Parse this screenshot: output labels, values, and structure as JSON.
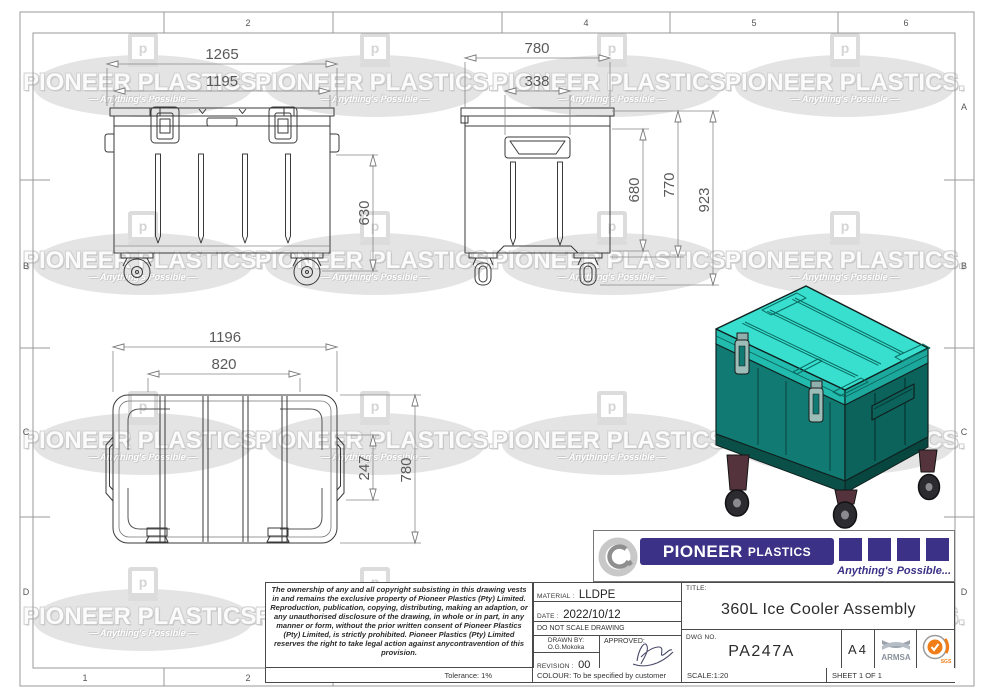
{
  "sheet": {
    "grid": {
      "top": [
        "2",
        "4",
        "5",
        "6"
      ],
      "bottom": [
        "1",
        "2"
      ],
      "left": [
        "B",
        "C",
        "D"
      ],
      "right": [
        "A",
        "B",
        "C",
        "D"
      ]
    }
  },
  "watermark": {
    "brand": "PIONEER PLASTICS.",
    "tagline": "— Anything's Possible —",
    "logo_letter": "p"
  },
  "views": {
    "front": {
      "dims": {
        "overall_width": "1265",
        "lid_width": "1195",
        "body_height": "630"
      }
    },
    "side": {
      "dims": {
        "overall_depth": "780",
        "handle_width": "338",
        "inner_height": "680",
        "body_height": "770",
        "overall_height": "923"
      }
    },
    "top": {
      "dims": {
        "overall_length": "1196",
        "lid_length": "820",
        "handle_span": "247",
        "overall_depth": "780"
      }
    }
  },
  "brand": {
    "name": "PIONEER",
    "name2": "PLASTICS",
    "tagline": "Anything's Possible...",
    "purple": "#3b3187"
  },
  "copyright": {
    "text": "The ownership of any and all copyright subsisting in this drawing vests in and remains the exclusive property of Pioneer Plastics (Pty) Limited. Reproduction, publication, copying, distributing, making an adaption, or any unauthorised disclosure of the drawing, in whole or in part, in any manner or form, without the prior written consent of Pioneer Plastics (Pty) Limited, is strictly prohibited. Pioneer Plastics (Pty) Limited reserves the right to take legal action against anycontravention of this provision.",
    "tolerance": "Tolerance: 1%"
  },
  "title_block": {
    "material_label": "MATERIAL :",
    "material": "LLDPE",
    "date_label": "DATE :",
    "date": "2022/10/12",
    "no_scale": "DO NOT SCALE DRAWING",
    "drawn_by_label": "DRAWN BY:",
    "drawn_by": "O.G.Mokoka",
    "approved_label": "APPROVED:",
    "revision_label": "REVISION :",
    "revision": "00",
    "title_label": "TITLE:",
    "title": "360L Ice Cooler Assembly",
    "dwg_label": "DWG NO.",
    "dwg_no": "PA247A",
    "paper_size": "A4",
    "colour": "COLOUR: To be specified by customer",
    "scale": "SCALE:1:20",
    "sheet": "SHEET 1 OF 1",
    "certs": {
      "armsa": "ARMSA",
      "sgs": "SGS"
    }
  }
}
